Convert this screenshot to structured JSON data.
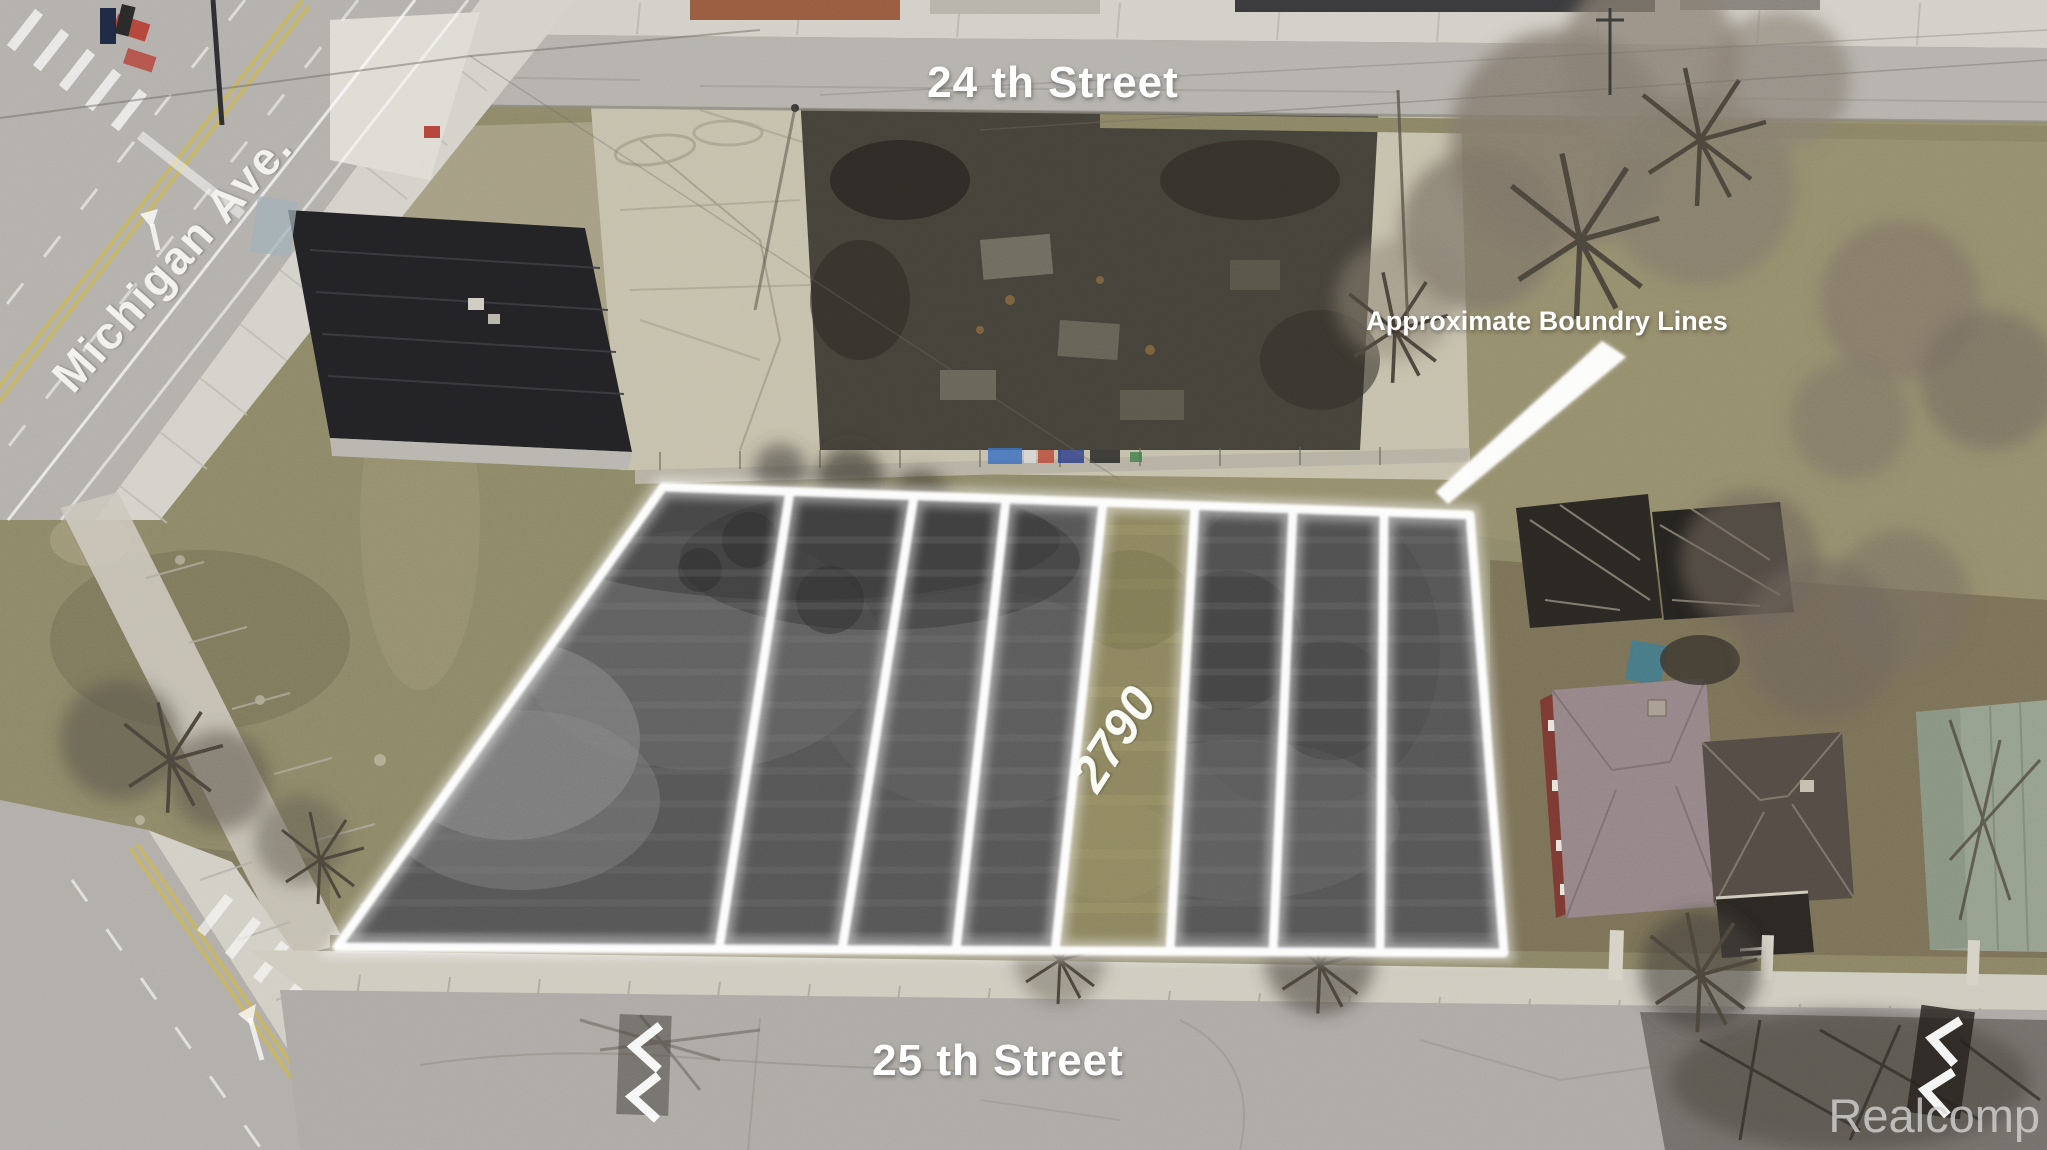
{
  "photo": {
    "kind": "aerial-drone-listing-photo",
    "width": 2047,
    "height": 1150
  },
  "labels": {
    "street_top": "24 th Street",
    "street_bottom": "25 th Street",
    "avenue": "Michigan Ave.",
    "boundary_note": "Approximate Boundry Lines",
    "parcel_number": "2790",
    "watermark": "Realcomp"
  },
  "lot": {
    "strip_count": 8,
    "highlighted_strip": 5,
    "boundary_color": "#ffffff",
    "highlight_color": "#8d8660"
  },
  "colors": {
    "label_text": "#ffffff",
    "watermark_text": "#d5d5d5",
    "road_asphalt": "#b4b1ad",
    "grass": "#8e8968",
    "dark_soil": "#45423a"
  },
  "icons": {
    "left_road_marking": "double-chevron-left-icon",
    "right_road_marking": "double-chevron-left-icon"
  }
}
